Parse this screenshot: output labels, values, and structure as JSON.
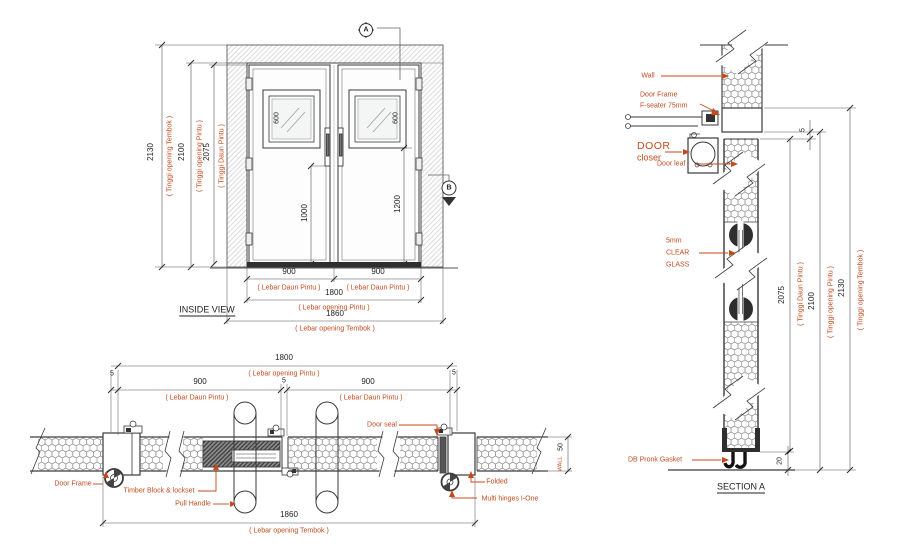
{
  "colors": {
    "accent_red": "#c44a1e",
    "line_dark": "#3a3a3a"
  },
  "inside_view": {
    "title": "INSIDE VIEW",
    "marker_a": "A",
    "marker_b": "B",
    "dim_wall_h": "2130",
    "dim_wall_h_label": "( Tinggi opening Tembok )",
    "dim_open_h": "2100",
    "dim_open_h_label": "( Tinggi opening Pintu )",
    "dim_leaf_h": "2075",
    "dim_leaf_h_label": "( Tinggi Daun Pintu )",
    "dim_window_l": "600",
    "dim_window_r": "600",
    "dim_mid_l": "1000",
    "dim_mid_r": "1200",
    "dim_leaf_w_l": "900",
    "dim_leaf_w_l_label": "( Lebar Daun Pintu )",
    "dim_leaf_w_r": "900",
    "dim_leaf_w_r_label": "( Lebar Daun Pintu )",
    "dim_open_w": "1800",
    "dim_open_w_label": "( Lebar opening Pintu )",
    "dim_wall_w": "1860",
    "dim_wall_w_label": "( Lebar opening Tembok )"
  },
  "plan_view": {
    "dim_open_w": "1800",
    "dim_open_w_label": "( Lebar opening Pintu )",
    "dim_leaf_l": "900",
    "dim_leaf_l_label": "( Lebar Daun Pintu )",
    "dim_leaf_r": "900",
    "dim_leaf_r_label": "( Lebar Daun Pintu )",
    "dim_gap_left": "5",
    "dim_gap_center": "5",
    "dim_gap_right": "5",
    "dim_wall_w": "1860",
    "dim_wall_w_label": "( Lebar opening Tembok )",
    "dim_wall_thk": "50",
    "dim_wall_thk_label": "WALL",
    "label_door_frame": "Door Frame",
    "label_timber_block": "Timber Block & lockset",
    "label_pull_handle": "Pull Handle",
    "label_door_seal": "Door seal",
    "label_folded": "Folded",
    "label_multi_hinges": "Multi hinges I-One"
  },
  "section_a": {
    "title": "SECTION A",
    "label_wall": "Wall",
    "label_door_frame_1": "Door Frame",
    "label_door_frame_2": "F-seater 75mm",
    "label_closer_1": "DOOR",
    "label_closer_2": "closer",
    "label_door_leaf": "Door leaf",
    "label_glass_1": "5mm",
    "label_glass_2": "CLEAR",
    "label_glass_3": "GLASS",
    "label_gasket": "DB Pronk Gasket",
    "dim_top_gap": "5",
    "dim_bottom_gap": "20",
    "dim_leaf_h": "2075",
    "dim_leaf_h_label": "( Tinggi Daun Pintu )",
    "dim_open_h": "2100",
    "dim_open_h_label": "( Tinggi opening Pintu )",
    "dim_wall_h": "2130",
    "dim_wall_h_label": "( Tinggi opening Tembok )"
  }
}
